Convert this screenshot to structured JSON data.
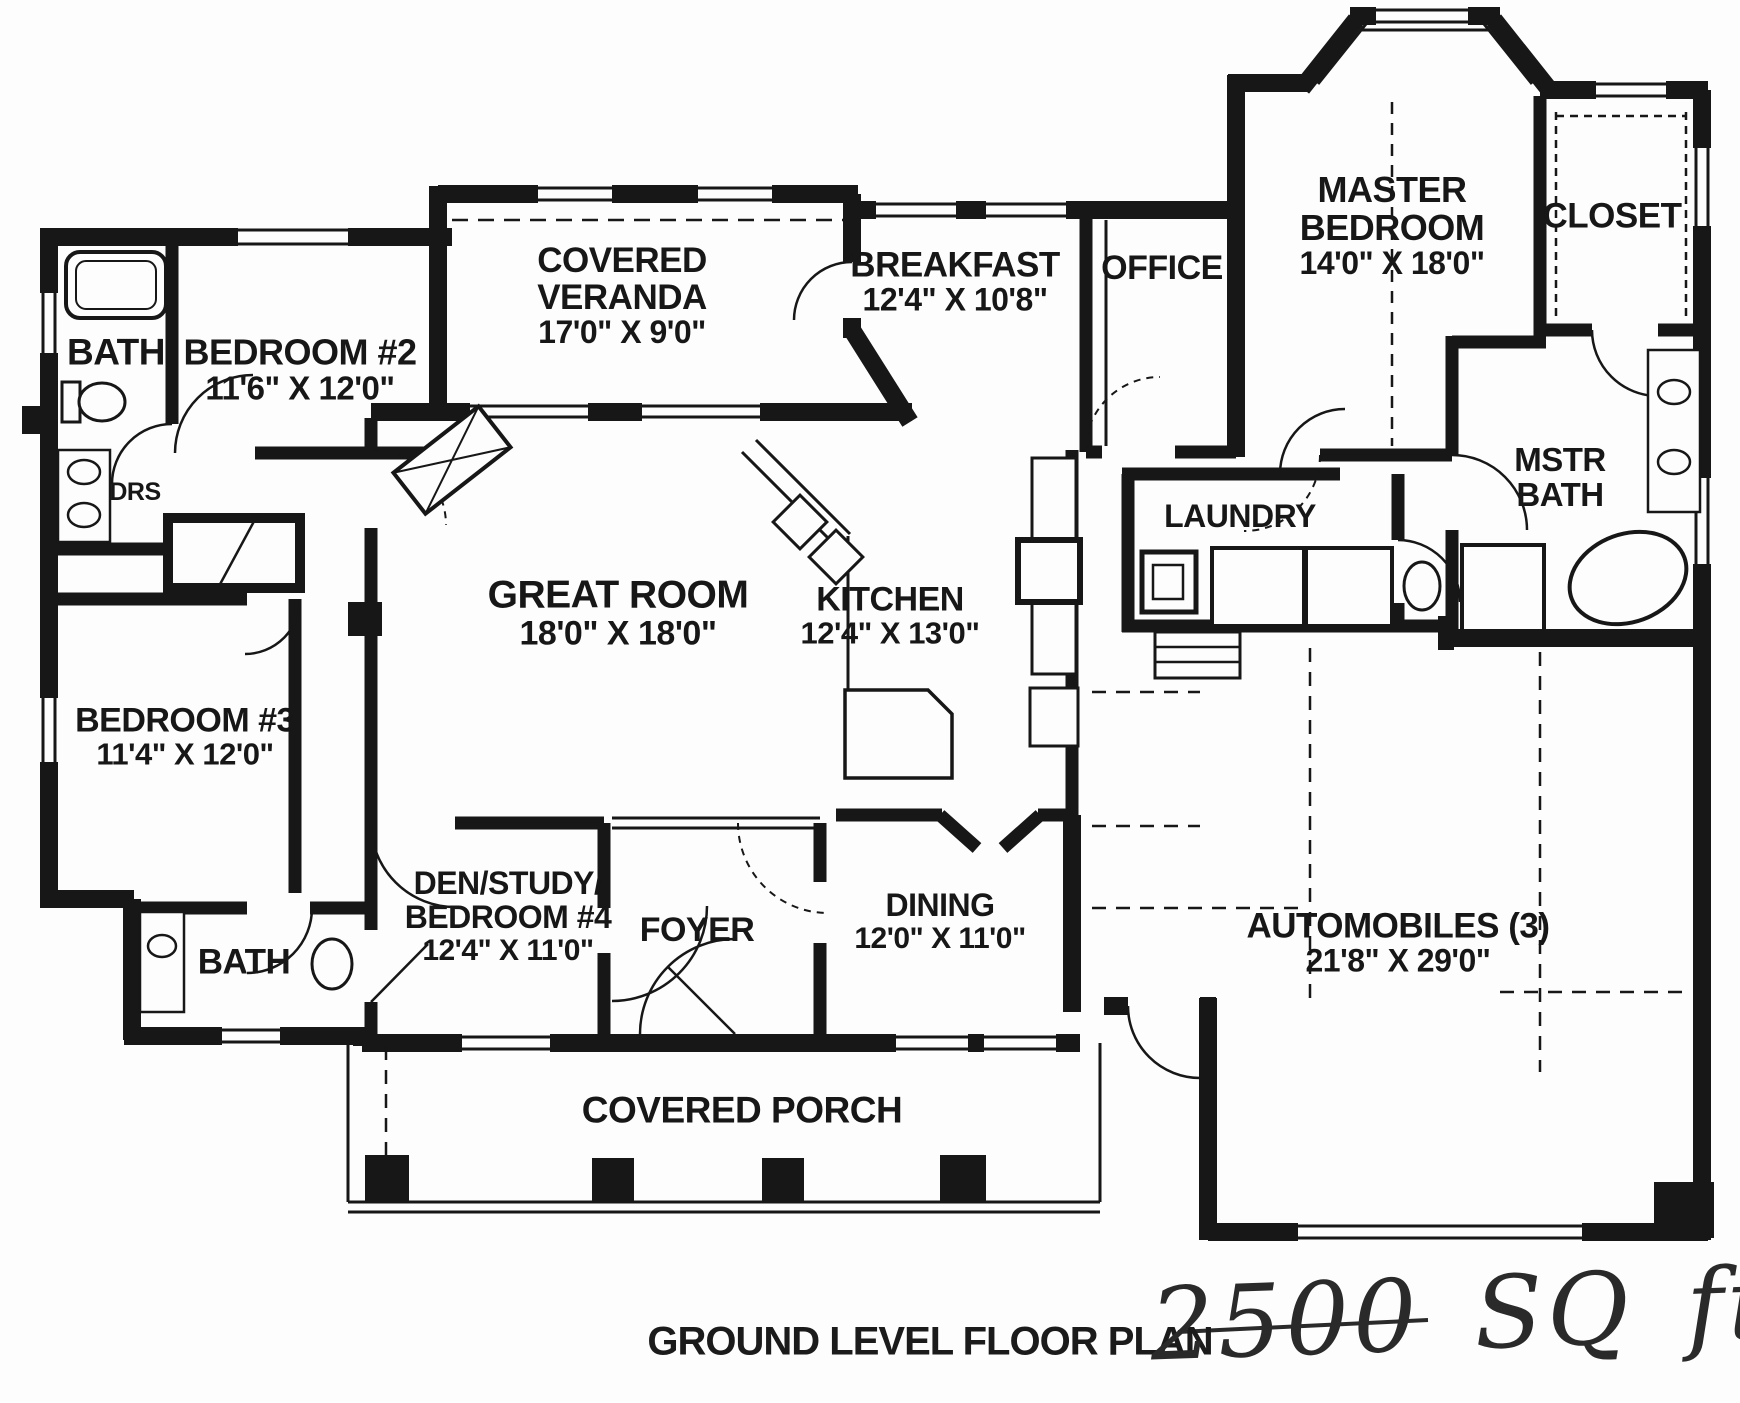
{
  "meta": {
    "caption": "GROUND LEVEL FLOOR PLAN",
    "handwritten_area": "2500 SQ ft."
  },
  "colors": {
    "ink": "#171717",
    "paper": "#fdfdfd"
  },
  "rooms": {
    "bath_top": {
      "name": "BATH"
    },
    "bedroom2": {
      "name": "BEDROOM #2",
      "dims": "11'6\" X 12'0\""
    },
    "drs": {
      "name": "DRS"
    },
    "veranda": {
      "l1": "COVERED",
      "l2": "VERANDA",
      "dims": "17'0\" X 9'0\""
    },
    "breakfast": {
      "name": "BREAKFAST",
      "dims": "12'4\" X 10'8\""
    },
    "office": {
      "name": "OFFICE"
    },
    "master": {
      "l1": "MASTER",
      "l2": "BEDROOM",
      "dims": "14'0\" X 18'0\""
    },
    "closet": {
      "name": "CLOSET"
    },
    "mstr_bath": {
      "l1": "MSTR",
      "l2": "BATH"
    },
    "laundry": {
      "name": "LAUNDRY"
    },
    "great_room": {
      "name": "GREAT ROOM",
      "dims": "18'0\" X 18'0\""
    },
    "kitchen": {
      "name": "KITCHEN",
      "dims": "12'4\" X 13'0\""
    },
    "bedroom3": {
      "name": "BEDROOM #3",
      "dims": "11'4\" X 12'0\""
    },
    "den": {
      "l1": "DEN/STUDY/",
      "l2": "BEDROOM #4",
      "dims": "12'4\" X 11'0\""
    },
    "foyer": {
      "name": "FOYER"
    },
    "dining": {
      "name": "DINING",
      "dims": "12'0\" X 11'0\""
    },
    "bath_bottom": {
      "name": "BATH"
    },
    "porch": {
      "name": "COVERED PORCH"
    },
    "garage": {
      "name": "AUTOMOBILES (3)",
      "dims": "21'8\" X 29'0\""
    }
  }
}
